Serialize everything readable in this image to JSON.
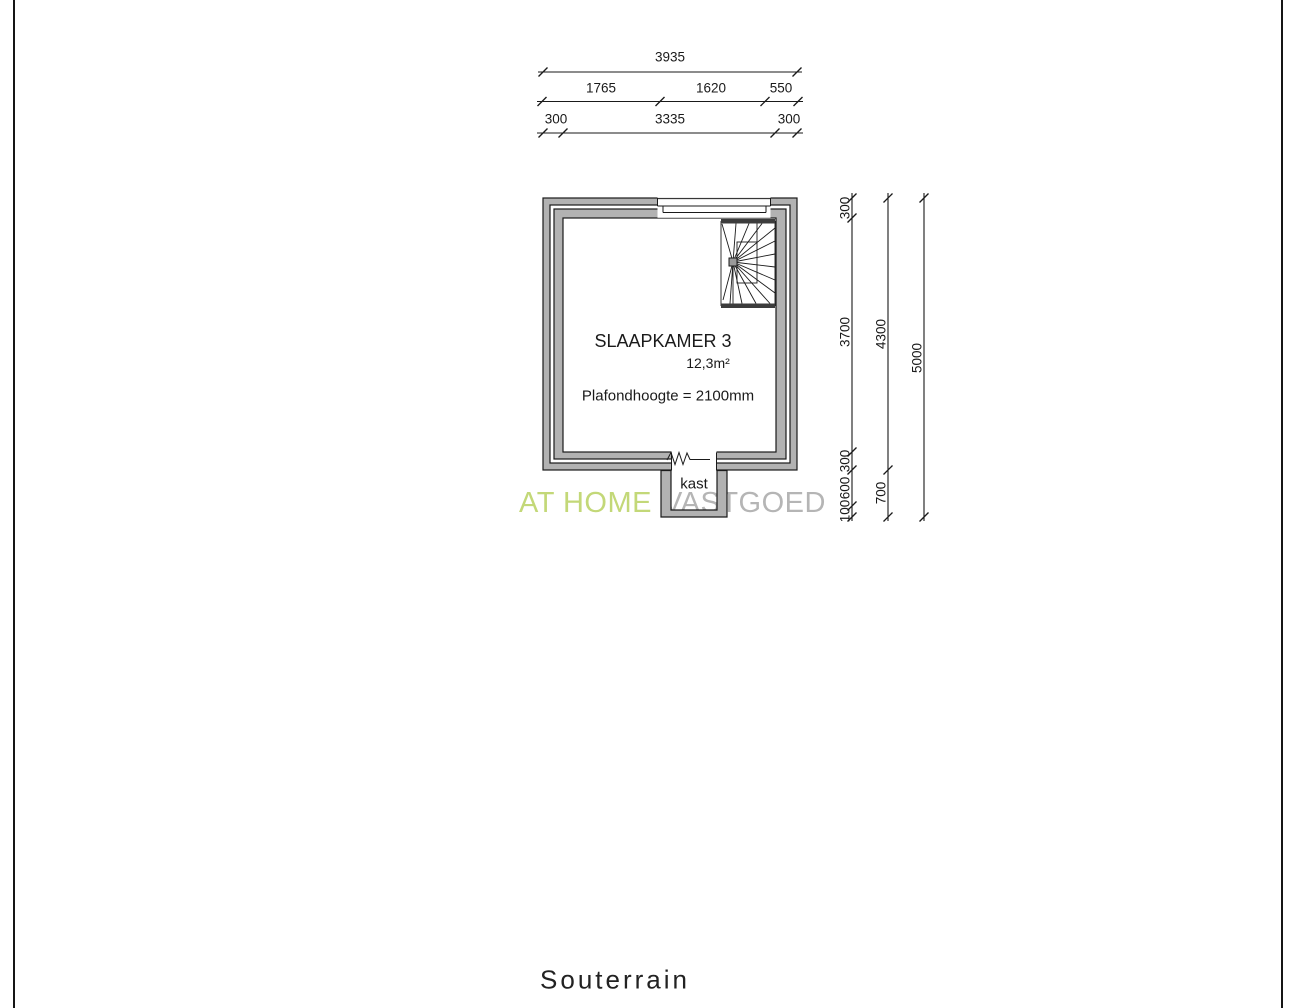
{
  "page": {
    "floor_label": "Souterrain"
  },
  "room": {
    "name": "SLAAPKAMER 3",
    "area": "12,3m²",
    "ceiling_note": "Plafondhoogte = 2100mm",
    "closet_label": "kast"
  },
  "watermark": {
    "part1": "AT HOME",
    "part2": "VASTGOED",
    "green_color": "#c3d878",
    "gray_color": "#b5b5b5"
  },
  "dimensions": {
    "top": {
      "row1": [
        "3935"
      ],
      "row2": [
        "1765",
        "1620",
        "550"
      ],
      "row3": [
        "300",
        "3335",
        "300"
      ]
    },
    "right": {
      "col1": [
        "300",
        "3700",
        "300",
        "600",
        "100"
      ],
      "col2": [
        "4300",
        "700"
      ],
      "col3": [
        "5000"
      ]
    }
  },
  "colors": {
    "wall_fill": "#b2b2b2",
    "line": "#1a1a1a",
    "stair_bar": "#3c3c3c"
  }
}
